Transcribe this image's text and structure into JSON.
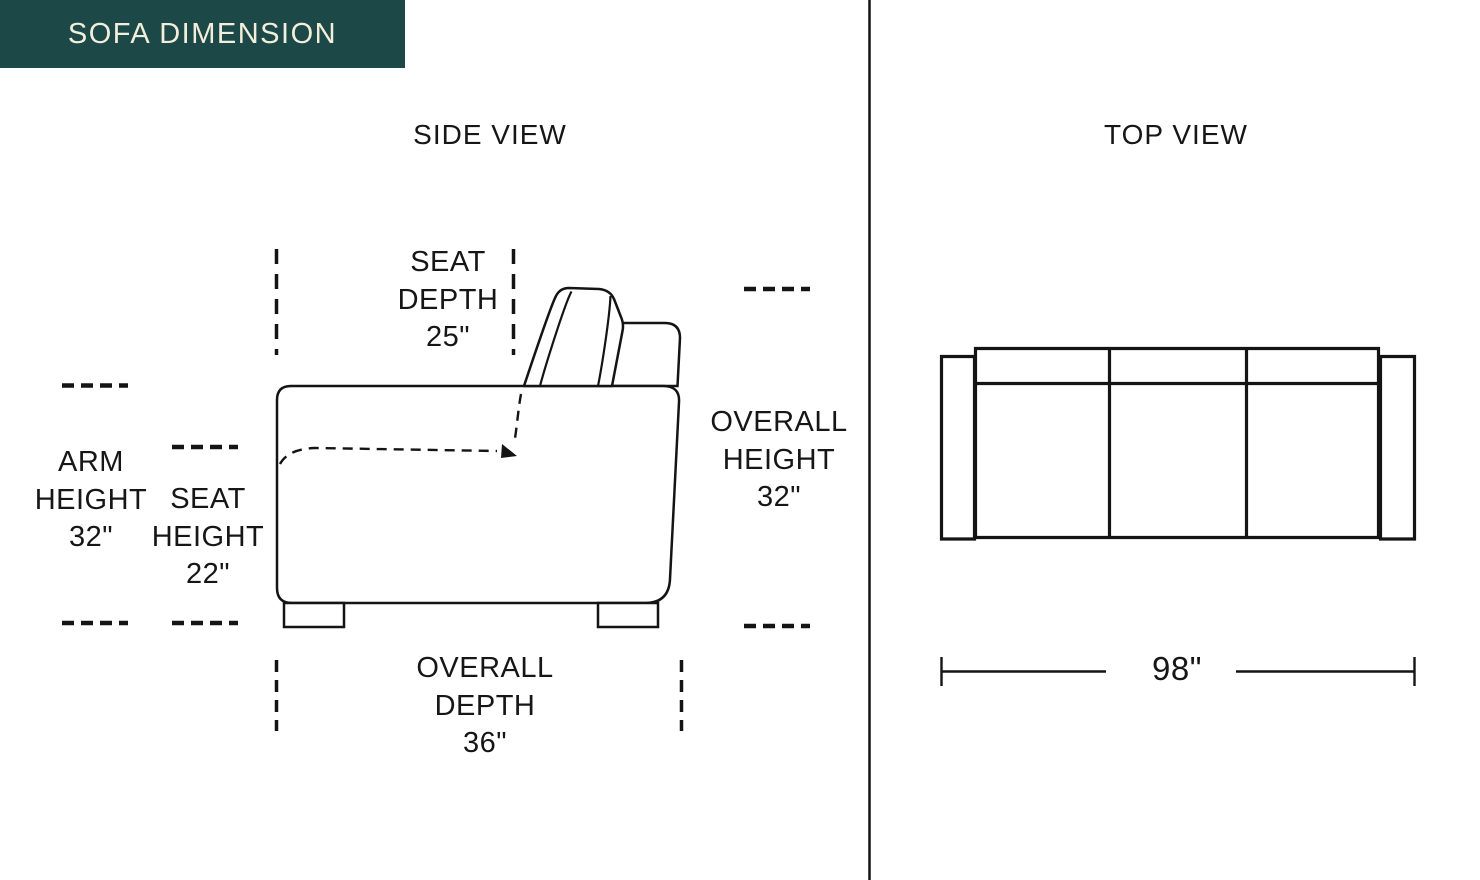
{
  "title": "SOFA DIMENSION",
  "colors": {
    "badge_bg": "#1C4947",
    "badge_text": "#F2EEDB",
    "line": "#141414"
  },
  "side_view": {
    "heading": "SIDE VIEW",
    "seat_depth": [
      "SEAT",
      "DEPTH",
      "25\""
    ],
    "arm_height": [
      "ARM",
      "HEIGHT",
      "32\""
    ],
    "seat_height": [
      "SEAT",
      "HEIGHT",
      "22\""
    ],
    "overall_height": [
      "OVERALL",
      "HEIGHT",
      "32\""
    ],
    "overall_depth": [
      "OVERALL",
      "DEPTH",
      "36\""
    ]
  },
  "top_view": {
    "heading": "TOP VIEW",
    "overall_width": "98\""
  }
}
